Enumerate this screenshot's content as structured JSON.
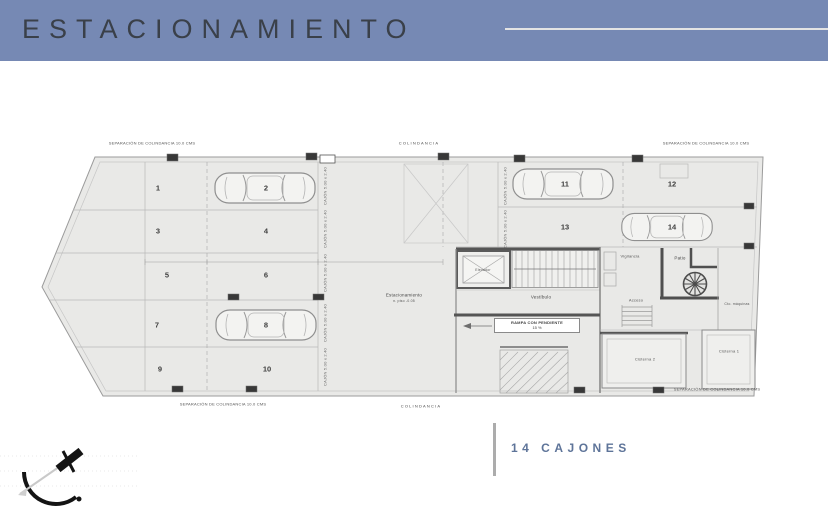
{
  "colors": {
    "header_bg": "#7689b4",
    "header_text": "#3a4049",
    "accent_text": "#5e7499",
    "plan_fill": "#e9e9e7"
  },
  "header": {
    "title": "ESTACIONAMIENTO"
  },
  "plan": {
    "boundary_labels": {
      "top_left": "SEPARACIÓN DE COLINDANCIA 10.0 CMS",
      "top_center": "COLINDANCIA",
      "top_right": "SEPARACIÓN DE COLINDANCIA 10.0 CMS",
      "bottom_left": "SEPARACIÓN DE COLINDANCIA 10.0 CMS",
      "bottom_center": "COLINDANCIA",
      "bottom_right": "SEPARACIÓN DE COLINDANCIA 10.0 CMS"
    },
    "stall_dim": "CAJÓN 5.00 x 2.40",
    "spaces": [
      "1",
      "2",
      "3",
      "4",
      "5",
      "6",
      "7",
      "8",
      "9",
      "10",
      "11",
      "12",
      "13",
      "14"
    ],
    "labels": {
      "elevator": "Elevador",
      "lobby": "Vestíbulo",
      "security": "Vigilancia",
      "patio": "Patio",
      "access": "Acceso",
      "machine_room": "Cto. máquinas",
      "cistern_2": "Cisterna 2",
      "cistern_1": "Cisterna 1",
      "parking_area": "Estacionamiento",
      "parking_level": "n. piso -0.05",
      "ramp_line1": "RAMPA CON PENDIENTE",
      "ramp_line2": "15 %"
    }
  },
  "footer": {
    "capacity": "14 CAJONES"
  }
}
